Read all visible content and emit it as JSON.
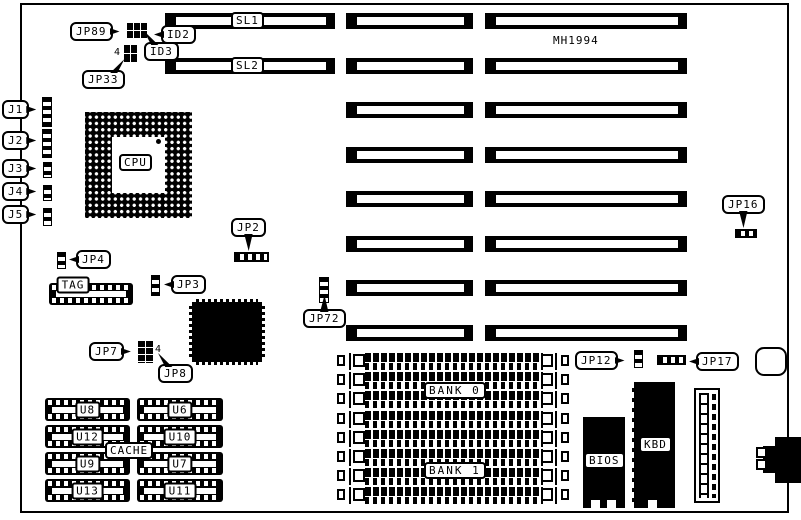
{
  "board": {
    "model": "MH1994"
  },
  "colors": {
    "ink": "#000000",
    "paper": "#ffffff"
  },
  "slots": {
    "sl1": "SL1",
    "sl2": "SL2"
  },
  "cpu": {
    "label": "CPU"
  },
  "connectors": {
    "j1": "J1",
    "j2": "J2",
    "j3": "J3",
    "j4": "J4",
    "j5": "J5",
    "tag": "TAG",
    "cache": "CACHE",
    "bank0": "BANK 0",
    "bank1": "BANK 1",
    "bios": "BIOS",
    "kbd": "KBD"
  },
  "jumpers": {
    "jp89": "JP89",
    "id2": "ID2",
    "id3": "ID3",
    "jp33": "JP33",
    "jp33_pin": "4",
    "jp2": "JP2",
    "jp4": "JP4",
    "jp3": "JP3",
    "jp72": "JP72",
    "jp7": "JP7",
    "jp7_pin": "4",
    "jp8": "JP8",
    "jp16": "JP16",
    "jp12": "JP12",
    "jp17": "JP17"
  },
  "cache_chips": [
    {
      "label": "U8"
    },
    {
      "label": "U6"
    },
    {
      "label": "U12"
    },
    {
      "label": "U10"
    },
    {
      "label": "U9"
    },
    {
      "label": "U7"
    },
    {
      "label": "U13"
    },
    {
      "label": "U11"
    }
  ]
}
